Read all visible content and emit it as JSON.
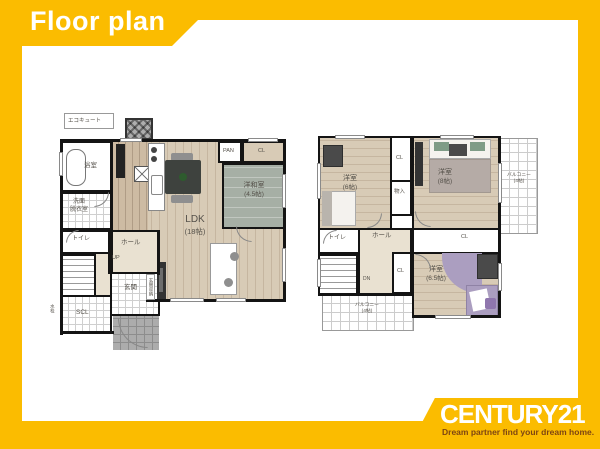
{
  "colors": {
    "brand_yellow": "#FBBC00",
    "wall": "#141414",
    "wood": "#D8CBB6",
    "wood_line": "#C6B6A0",
    "kitchen": "#CDBBA3",
    "tatami": "#A6AFA5",
    "hall": "#E9E1D1",
    "tile_line": "#CFCFCF",
    "porch": "#ACACAC",
    "balcony_line": "#CCCCCC",
    "furniture_dark": "#3E423E",
    "furniture_gray": "#8F8F8F",
    "purple": "#AB9EC0",
    "green": "#7F9C86",
    "label": "#55514A",
    "tagline_brown": "#7D4512"
  },
  "header": {
    "title": "Floor plan"
  },
  "brand": {
    "name": "CENTURY21",
    "tagline": "Dream partner find your dream home."
  },
  "floor1": {
    "eco_cute": "エコキュート",
    "bath": "浴室",
    "washroom_line1": "洗面",
    "washroom_line2": "脱衣室",
    "toilet": "トイレ",
    "hall": "ホール",
    "up": "UP",
    "entrance": "玄関",
    "entrance_storage": "玄関収納",
    "scl": "SCL",
    "water_tap": "水栓",
    "pan": "PAN",
    "closet": "CL",
    "ldk_name": "LDK",
    "ldk_size": "(18帖)",
    "tatami_name": "洋和室",
    "tatami_size": "(4.5帖)"
  },
  "floor2": {
    "room6_name": "洋室",
    "room6_size": "(6帖)",
    "closet_top": "CL",
    "storage": "物入",
    "room8_name": "洋室",
    "room8_size": "(8帖)",
    "balcony_right_name": "バルコニー",
    "balcony_right_size": "(4帖)",
    "toilet": "トイレ",
    "hall": "ホール",
    "down": "DN",
    "closet_mid": "CL",
    "closet_right": "CL",
    "room65_name": "洋室",
    "room65_size": "(6.5帖)",
    "balcony_bottom_name": "バルコニー",
    "balcony_bottom_size": "(4帖)"
  }
}
